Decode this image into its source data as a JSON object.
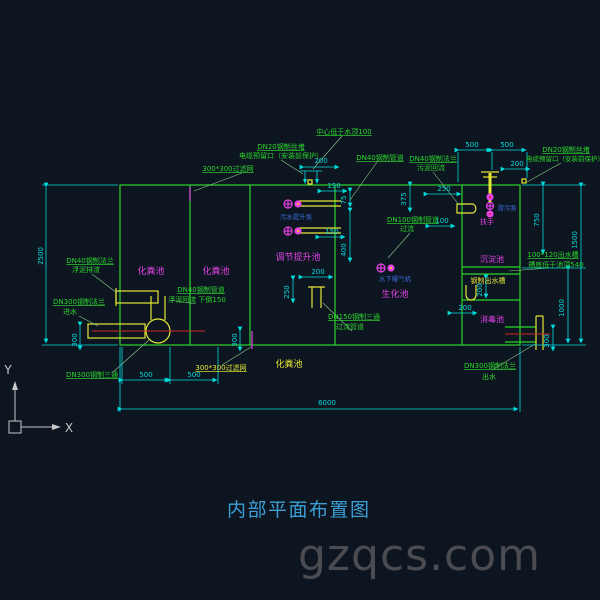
{
  "title": "内部平面布置图",
  "watermark": "gzqcs.com",
  "colors": {
    "green": "#2dd42d",
    "cyan": "#00dcdc",
    "magenta": "#e643e6",
    "yellow": "#e6e636",
    "blue": "#3a6ad4",
    "red": "#cc2a2a",
    "white": "#c8c8c8",
    "title_blue": "#3d9ed6",
    "watermark_gray": "#4b4b52",
    "background": "#0c1520"
  },
  "texts": [
    {
      "n": "note-dn20-plug-left-1",
      "t": "DN20钢制丝堵",
      "x": 281,
      "y": 149,
      "c": "green",
      "u": true
    },
    {
      "n": "note-dn20-plug-left-2",
      "t": "电缆预留口（安装前保护）",
      "x": 281,
      "y": 158,
      "c": "green"
    },
    {
      "n": "note-filter-top",
      "t": "300*300过滤网",
      "x": 228,
      "y": 171,
      "c": "green",
      "u": true
    },
    {
      "n": "note-center-below-top",
      "t": "中心低于水顶100",
      "x": 344,
      "y": 134,
      "c": "green",
      "u": true
    },
    {
      "n": "note-dn40-pipe-top",
      "t": "DN40钢制管道",
      "x": 380,
      "y": 160,
      "c": "green",
      "u": true
    },
    {
      "n": "note-dn40-flange-right-1",
      "t": "DN40钢制法兰",
      "x": 433,
      "y": 161,
      "c": "green",
      "u": true
    },
    {
      "n": "note-dn40-flange-right-2",
      "t": "污泥回流",
      "x": 431,
      "y": 170,
      "c": "green"
    },
    {
      "n": "note-dn100-pipe-1",
      "t": "DN100钢制管道",
      "x": 413,
      "y": 222,
      "c": "green",
      "u": true
    },
    {
      "n": "note-dn100-pipe-2",
      "t": "过流",
      "x": 407,
      "y": 231,
      "c": "green"
    },
    {
      "n": "note-dn150-tee-1",
      "t": "DN150钢制三通",
      "x": 354,
      "y": 319,
      "c": "green",
      "u": true
    },
    {
      "n": "note-dn150-tee-2",
      "t": "过流管道",
      "x": 350,
      "y": 329,
      "c": "green"
    },
    {
      "n": "note-dn40-flange-left-1",
      "t": "DN40钢制法兰",
      "x": 90,
      "y": 263,
      "c": "green",
      "u": true
    },
    {
      "n": "note-dn40-flange-left-2",
      "t": "浮泥排渣",
      "x": 86,
      "y": 272,
      "c": "green"
    },
    {
      "n": "note-dn300-flange-in-1",
      "t": "DN300钢制法兰",
      "x": 79,
      "y": 304,
      "c": "green",
      "u": true
    },
    {
      "n": "note-dn300-flange-in-2",
      "t": "进水",
      "x": 70,
      "y": 314,
      "c": "green"
    },
    {
      "n": "note-dn300-tee",
      "t": "DN300钢制三通",
      "x": 92,
      "y": 377,
      "c": "green",
      "u": true
    },
    {
      "n": "note-dn40-return-1",
      "t": "DN40钢制管道",
      "x": 201,
      "y": 292,
      "c": "green",
      "u": true
    },
    {
      "n": "note-dn40-return-2",
      "t": "浮泥回流 下倒150",
      "x": 197,
      "y": 302,
      "c": "green"
    },
    {
      "n": "note-dn20-plug-right-1",
      "t": "DN20钢制丝堵",
      "x": 566,
      "y": 152,
      "c": "green",
      "u": true
    },
    {
      "n": "note-dn20-plug-right-2",
      "t": "电缆预留口（安装前保护）",
      "x": 565,
      "y": 161,
      "c": "green",
      "s": 6.5
    },
    {
      "n": "note-outlet-channel-1",
      "t": "100*120出水槽",
      "x": 553,
      "y": 257,
      "c": "green",
      "u": true
    },
    {
      "n": "note-outlet-channel-2",
      "t": "槽底低于池顶540",
      "x": 556,
      "y": 267,
      "c": "green"
    },
    {
      "n": "note-dn300-flange-out-1",
      "t": "DN300钢制法兰",
      "x": 490,
      "y": 368,
      "c": "green",
      "u": true
    },
    {
      "n": "note-dn300-flange-out-2",
      "t": "出水",
      "x": 489,
      "y": 379,
      "c": "green"
    },
    {
      "n": "label-septic-bottom",
      "t": "化粪池",
      "x": 289,
      "y": 367,
      "c": "yellow",
      "s": 9
    },
    {
      "n": "note-filter-bottom",
      "t": "300*300过滤网",
      "x": 221,
      "y": 370,
      "c": "yellow",
      "u": true
    },
    {
      "n": "label-steel-outlet-channel",
      "t": "钢制出水槽",
      "x": 488,
      "y": 283,
      "c": "yellow"
    },
    {
      "n": "label-septic-1",
      "t": "化粪池",
      "x": 151,
      "y": 274,
      "c": "magenta",
      "s": 9
    },
    {
      "n": "label-septic-2",
      "t": "化粪池",
      "x": 216,
      "y": 274,
      "c": "magenta",
      "s": 9
    },
    {
      "n": "label-regulating-lift-tank",
      "t": "调节提升池",
      "x": 298,
      "y": 260,
      "c": "magenta",
      "s": 9
    },
    {
      "n": "label-bio-tank",
      "t": "生化池",
      "x": 395,
      "y": 297,
      "c": "magenta",
      "s": 9
    },
    {
      "n": "label-sediment-tank",
      "t": "沉淀池",
      "x": 492,
      "y": 262,
      "c": "magenta",
      "s": 8
    },
    {
      "n": "label-disinfect-tank",
      "t": "消毒池",
      "x": 492,
      "y": 322,
      "c": "magenta",
      "s": 8
    },
    {
      "n": "label-handrail",
      "t": "扶手",
      "x": 487,
      "y": 224,
      "c": "magenta",
      "s": 7
    },
    {
      "n": "label-sewage-lift-pump",
      "t": "污水提升泵",
      "x": 296,
      "y": 219,
      "c": "blue",
      "s": 6.5
    },
    {
      "n": "label-underwater-aerator",
      "t": "水下曝气机",
      "x": 395,
      "y": 281,
      "c": "blue",
      "s": 6.5
    },
    {
      "n": "label-submersible-pump",
      "t": "潜污泵",
      "x": 507,
      "y": 210,
      "c": "blue",
      "s": 6.5
    },
    {
      "n": "dim-2500",
      "t": "2500",
      "x": 43,
      "y": 256,
      "c": "cyan",
      "r": -90
    },
    {
      "n": "dim-300-left",
      "t": "300",
      "x": 77,
      "y": 340,
      "c": "cyan",
      "r": -90
    },
    {
      "n": "dim-500-a",
      "t": "500",
      "x": 146,
      "y": 377,
      "c": "cyan"
    },
    {
      "n": "dim-500-b",
      "t": "500",
      "x": 194,
      "y": 377,
      "c": "cyan"
    },
    {
      "n": "dim-300-filter",
      "t": "300",
      "x": 237,
      "y": 340,
      "c": "cyan",
      "r": -90
    },
    {
      "n": "dim-6000",
      "t": "6000",
      "x": 327,
      "y": 405,
      "c": "cyan"
    },
    {
      "n": "dim-200-top",
      "t": "200",
      "x": 321,
      "y": 163,
      "c": "cyan"
    },
    {
      "n": "dim-150-a",
      "t": "150",
      "x": 334,
      "y": 188,
      "c": "cyan"
    },
    {
      "n": "dim-75",
      "t": "75",
      "x": 346,
      "y": 200,
      "c": "cyan",
      "r": -90
    },
    {
      "n": "dim-400",
      "t": "400",
      "x": 346,
      "y": 250,
      "c": "cyan",
      "r": -90
    },
    {
      "n": "dim-150-b",
      "t": "150",
      "x": 332,
      "y": 234,
      "c": "cyan"
    },
    {
      "n": "dim-200-mid",
      "t": "200",
      "x": 318,
      "y": 274,
      "c": "cyan"
    },
    {
      "n": "dim-250-v",
      "t": "250",
      "x": 289,
      "y": 292,
      "c": "cyan",
      "r": -90
    },
    {
      "n": "dim-375",
      "t": "375",
      "x": 406,
      "y": 199,
      "c": "cyan",
      "r": -90
    },
    {
      "n": "dim-250-r",
      "t": "250",
      "x": 444,
      "y": 191,
      "c": "cyan"
    },
    {
      "n": "dim-100",
      "t": "100",
      "x": 442,
      "y": 223,
      "c": "cyan"
    },
    {
      "n": "dim-500-c",
      "t": "500",
      "x": 472,
      "y": 147,
      "c": "cyan"
    },
    {
      "n": "dim-500-d",
      "t": "500",
      "x": 507,
      "y": 147,
      "c": "cyan"
    },
    {
      "n": "dim-200-tr",
      "t": "200",
      "x": 517,
      "y": 166,
      "c": "cyan"
    },
    {
      "n": "dim-750",
      "t": "750",
      "x": 539,
      "y": 220,
      "c": "cyan",
      "r": -90
    },
    {
      "n": "dim-1500",
      "t": "1500",
      "x": 577,
      "y": 240,
      "c": "cyan",
      "r": -90
    },
    {
      "n": "dim-1000",
      "t": "1000",
      "x": 564,
      "y": 308,
      "c": "cyan",
      "r": -90
    },
    {
      "n": "dim-300-right",
      "t": "300",
      "x": 549,
      "y": 341,
      "c": "cyan",
      "r": -90
    },
    {
      "n": "dim-200-rv",
      "t": "200",
      "x": 482,
      "y": 290,
      "c": "cyan",
      "r": -90
    },
    {
      "n": "dim-200-rh",
      "t": "200",
      "x": 465,
      "y": 310,
      "c": "cyan"
    },
    {
      "n": "ucs-y-label",
      "t": "Y",
      "x": 8,
      "y": 374,
      "c": "white",
      "s": 12
    },
    {
      "n": "ucs-x-label",
      "t": "X",
      "x": 69,
      "y": 432,
      "c": "white",
      "s": 12
    }
  ]
}
